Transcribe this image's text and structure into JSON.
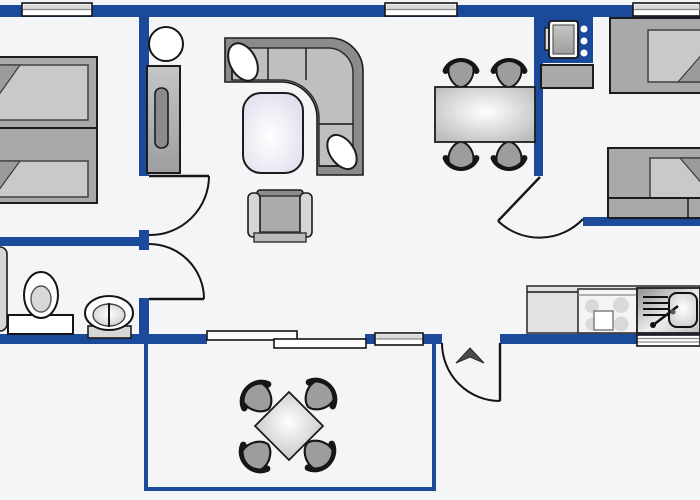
{
  "meta": {
    "type": "floor-plan",
    "description": "apartment / mobile-home floor plan with terrace",
    "width": 700,
    "height": 500
  },
  "colors": {
    "wall": "#1b4a9b",
    "floor": "#f4f5f7",
    "furniture_mid": "#a9a9a9",
    "furniture_light": "#d6d6d6",
    "furniture_dark": "#8b8b8b",
    "outline": "#1c1c1c",
    "coffee_table_tint": "#e2e2f0"
  },
  "rooms": [
    {
      "id": "bedroom-left",
      "furniture": [
        "single-bed",
        "single-bed"
      ]
    },
    {
      "id": "bathroom",
      "furniture": [
        "shower-cabinet",
        "toilet",
        "washbasin",
        "bath-window-shelf"
      ]
    },
    {
      "id": "living-room",
      "furniture": [
        "round-side-table",
        "wardrobe",
        "corner-sofa",
        "sofa-pillow",
        "sofa-pillow",
        "coffee-table",
        "armchair"
      ]
    },
    {
      "id": "dining-area",
      "furniture": [
        "dining-table",
        "dining-chair",
        "dining-chair",
        "dining-chair",
        "dining-chair"
      ]
    },
    {
      "id": "bedroom-right",
      "furniture": [
        "boiler-unit",
        "cabinet",
        "single-bed",
        "single-bed"
      ]
    },
    {
      "id": "kitchen",
      "furniture": [
        "kitchen-counter",
        "cooktop",
        "kitchen-sink"
      ]
    },
    {
      "id": "terrace",
      "furniture": [
        "terrace-table",
        "terrace-chair",
        "terrace-chair",
        "terrace-chair",
        "terrace-chair"
      ]
    }
  ],
  "openings": {
    "top_windows": 3,
    "bottom_windows": 2,
    "bathroom_window": 1,
    "sliding_patio_door_panels": 2,
    "hinged_doors": 4,
    "entrance_arrow": "points-north"
  }
}
